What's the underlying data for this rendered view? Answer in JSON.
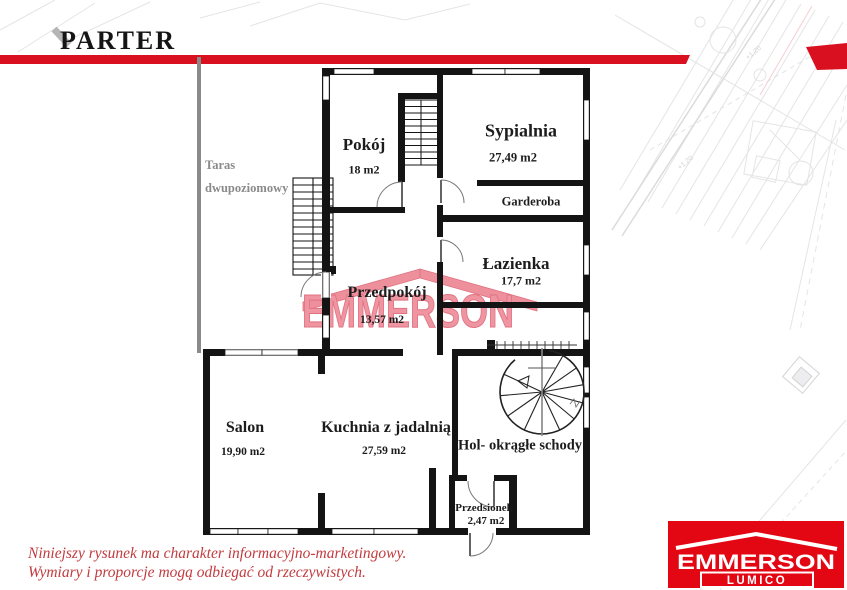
{
  "header": {
    "title": "PARTER",
    "accent_color": "#d8101f"
  },
  "plan": {
    "rooms": {
      "pokoj": {
        "name": "Pokój",
        "area": "18 m2"
      },
      "sypialnia": {
        "name": "Sypialnia",
        "area": "27,49 m2"
      },
      "garderoba": {
        "name": "Garderoba"
      },
      "lazienka": {
        "name": "Łazienka",
        "area": "17,7 m2"
      },
      "przedpokoj": {
        "name": "Przedpokój",
        "area": "13,57 m2"
      },
      "salon": {
        "name": "Salon",
        "area": "19,90 m2"
      },
      "kuchnia": {
        "name": "Kuchnia z jadalnią",
        "area": "27,59 m2"
      },
      "hol": {
        "name": "Hol- okrągłe schody"
      },
      "przedsionek": {
        "name": "Przedsionek",
        "area": "2,47 m2"
      }
    },
    "outside": {
      "taras_line1": "Taras",
      "taras_line2": "dwupoziomowy",
      "taras_color": "#8a8a8a"
    },
    "background_site_mark": "+1,20",
    "wall_color": "#141414"
  },
  "watermark": {
    "text": "EMMERSON",
    "color": "#ec8492"
  },
  "footer": {
    "disclaimer_line1": "Niniejszy rysunek ma charakter informacyjno-marketingowy.",
    "disclaimer_line2": "Wymiary i proporcje mogą odbiegać od rzeczywistych.",
    "disclaimer_color": "#c23b3f"
  },
  "logo": {
    "brand": "EMMERSON",
    "subbrand": "LUMICO",
    "color": "#e30613"
  }
}
